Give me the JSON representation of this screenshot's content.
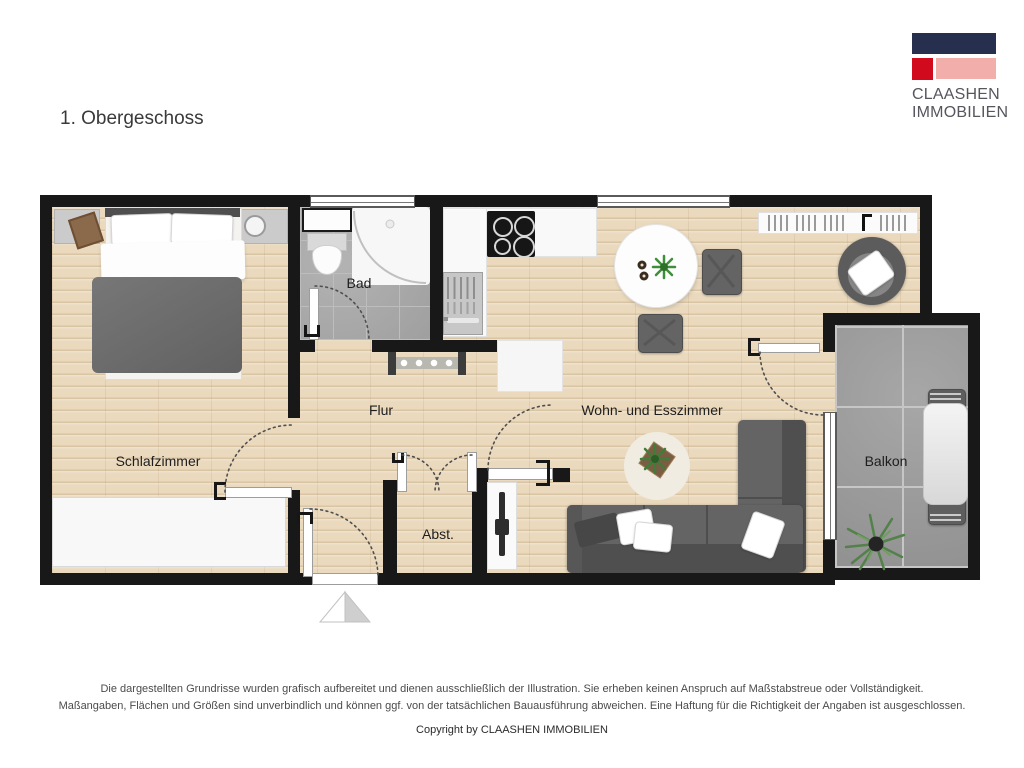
{
  "title": "1. Obergeschoss",
  "logo": {
    "name_line1": "CLAASHEN",
    "name_line2": "IMMOBILIEN",
    "colors": {
      "navy": "#262f4e",
      "red": "#d20a1e",
      "pink": "#f1aeab"
    }
  },
  "plan": {
    "rooms": [
      {
        "id": "bedroom",
        "label": "Schlafzimmer"
      },
      {
        "id": "bath",
        "label": "Bad"
      },
      {
        "id": "hall",
        "label": "Flur"
      },
      {
        "id": "storage",
        "label": "Abst."
      },
      {
        "id": "living",
        "label": "Wohn- und Esszimmer"
      },
      {
        "id": "balcony",
        "label": "Balkon"
      }
    ],
    "colors": {
      "wall": "#181818",
      "wood_floor": "#ead9bd",
      "bath_tile": "#a9a9a9",
      "balcony_tile": "#9d9d9d",
      "sofa_gray": "#646464",
      "plant_green": "#3f7d38"
    }
  },
  "footer": {
    "disclaimer_line1": "Die dargestellten Grundrisse wurden grafisch aufbereitet und dienen ausschließlich der Illustration. Sie erheben keinen Anspruch auf Maßstabstreue oder Vollständigkeit.",
    "disclaimer_line2": "Maßangaben, Flächen und Größen sind unverbindlich und können ggf. von der tatsächlichen Bauausführung abweichen. Eine Haftung für die Richtigkeit der Angaben ist ausgeschlossen.",
    "copyright": "Copyright by CLAASHEN IMMOBILIEN"
  }
}
